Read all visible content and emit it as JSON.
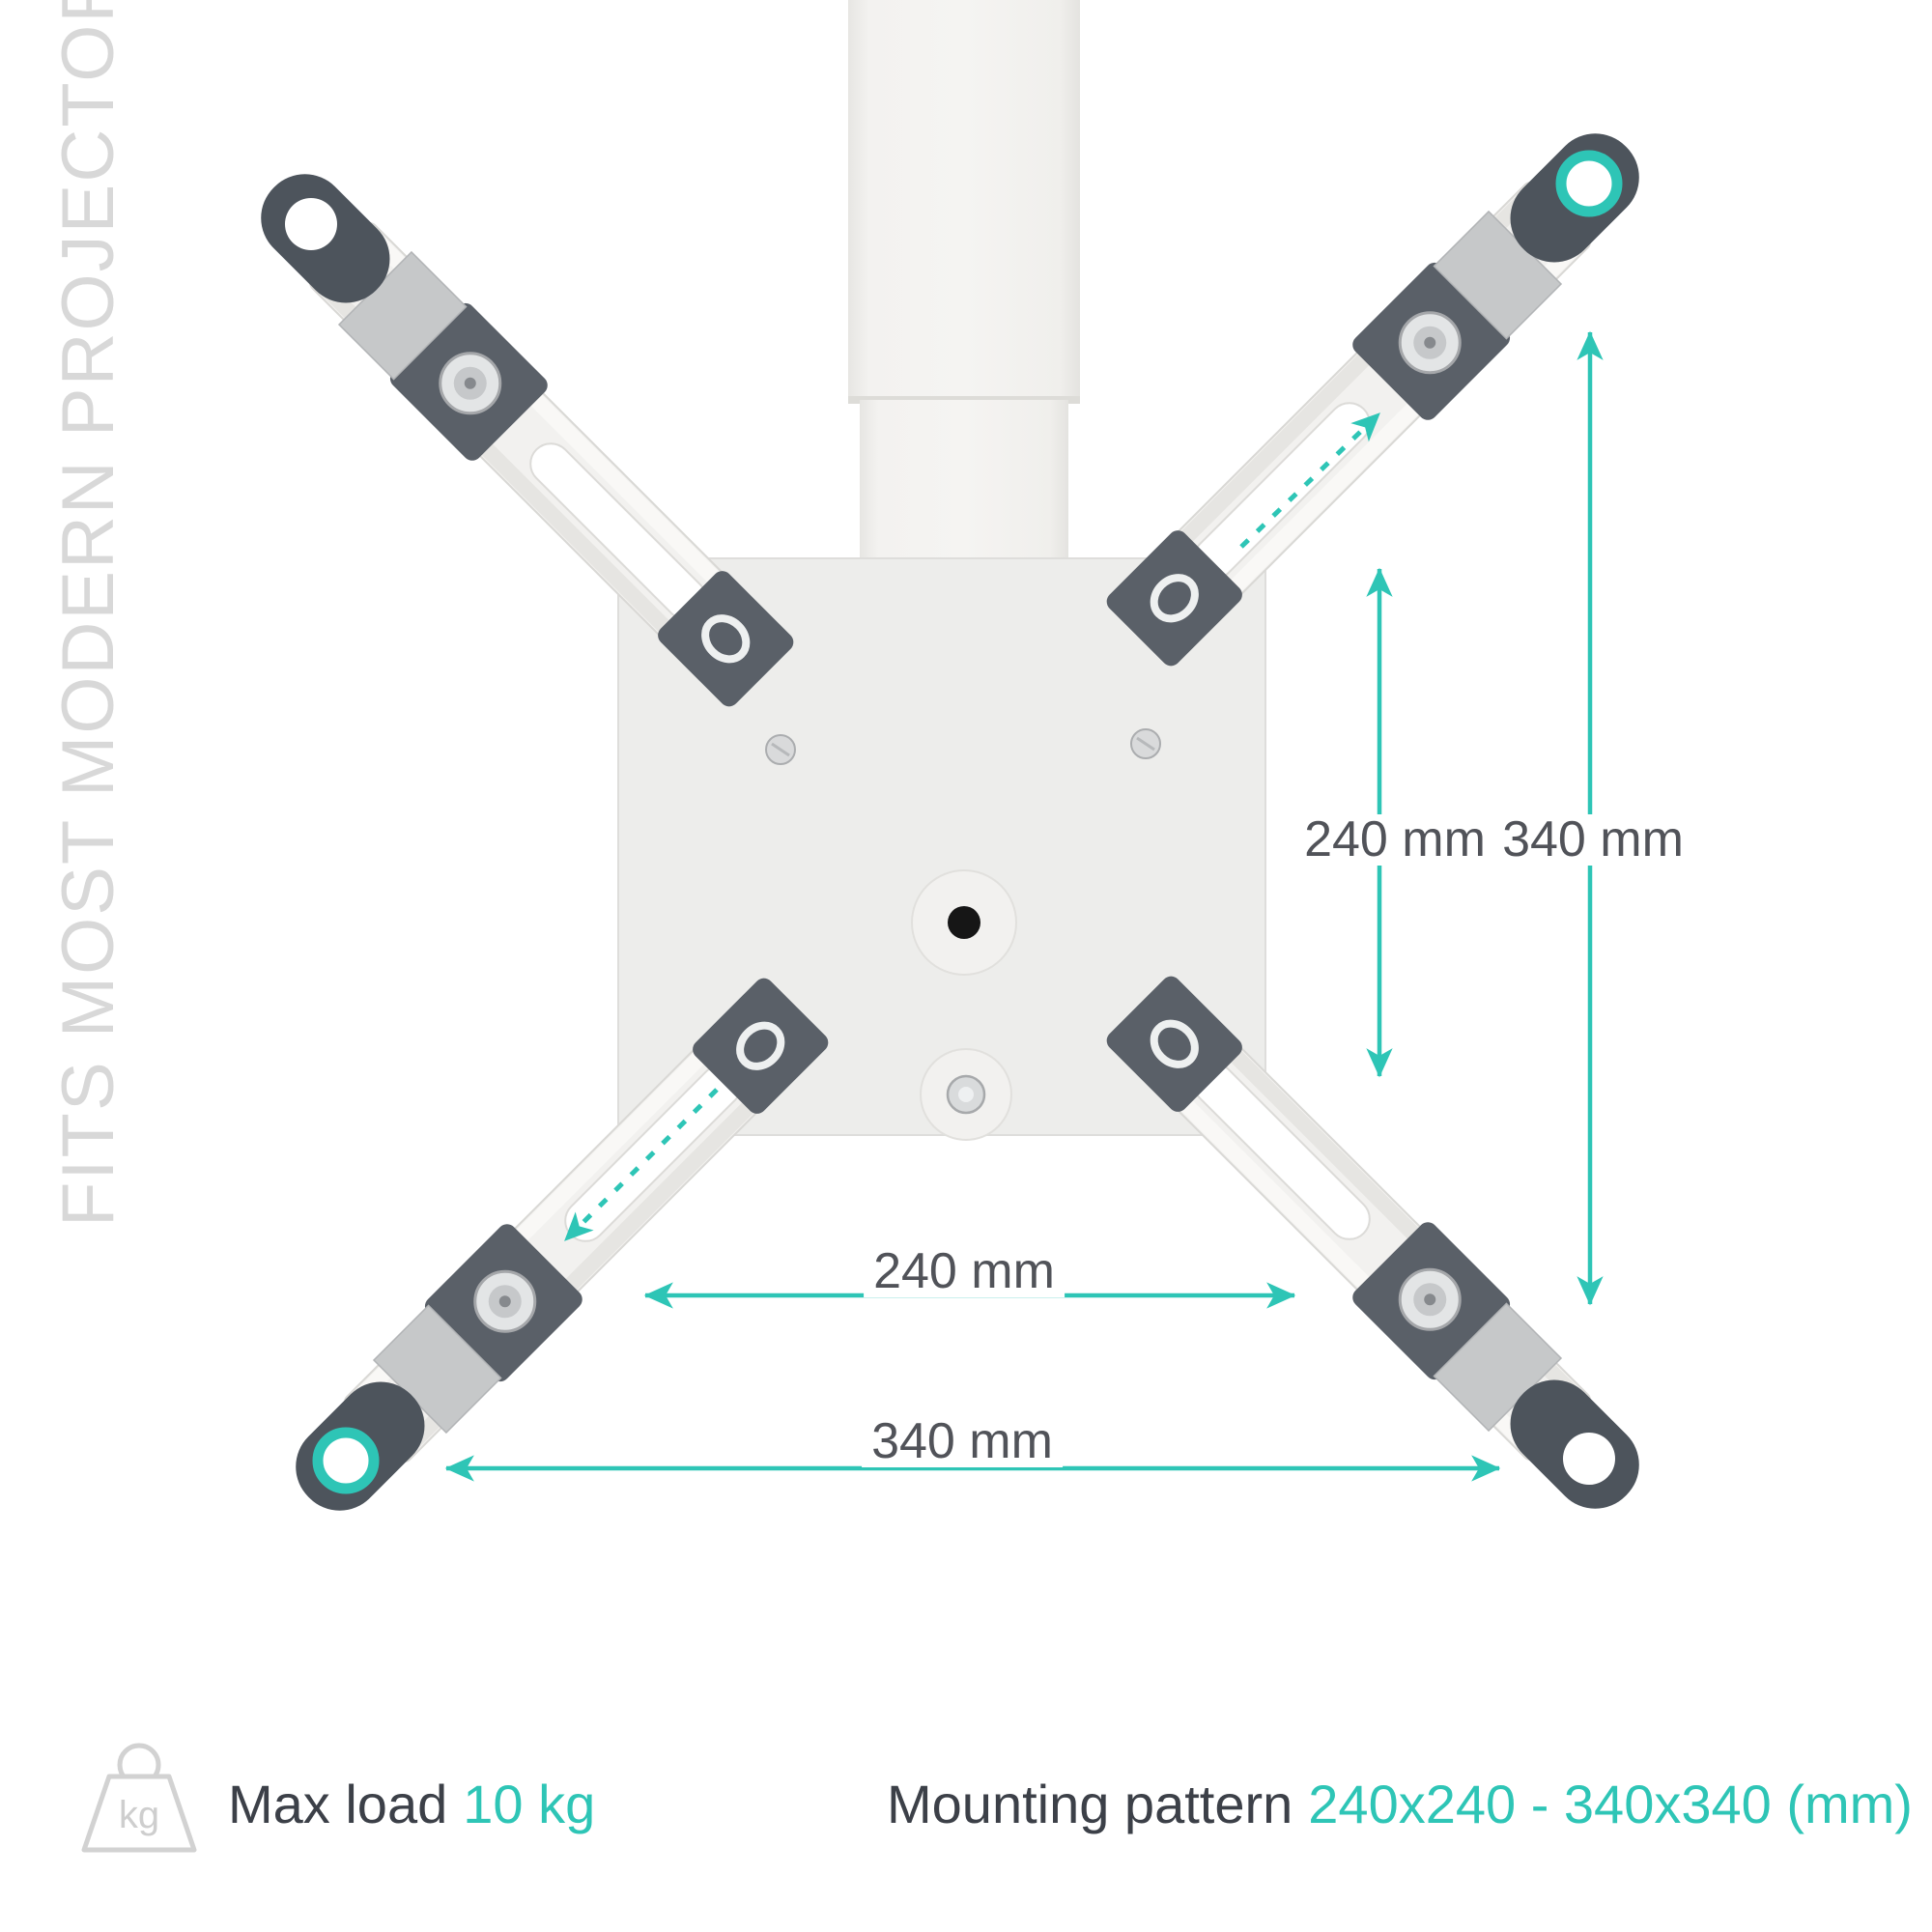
{
  "colors": {
    "accent": "#2ec5b6",
    "dim_label": "#515359",
    "footer_text": "#3c4048",
    "watermark": "#d8d8d8"
  },
  "watermark": {
    "text": "FITS MOST MODERN PROJECTORS"
  },
  "dimensions": {
    "vertical_inner": "240 mm",
    "vertical_outer": "340 mm",
    "horizontal_inner": "240 mm",
    "horizontal_outer": "340 mm"
  },
  "footer": {
    "kg_icon_label": "kg",
    "max_load_label": "Max load",
    "max_load_value": "10 kg",
    "mounting_pattern_label": "Mounting pattern",
    "mounting_pattern_value": "240x240 - 340x340 (mm)"
  }
}
